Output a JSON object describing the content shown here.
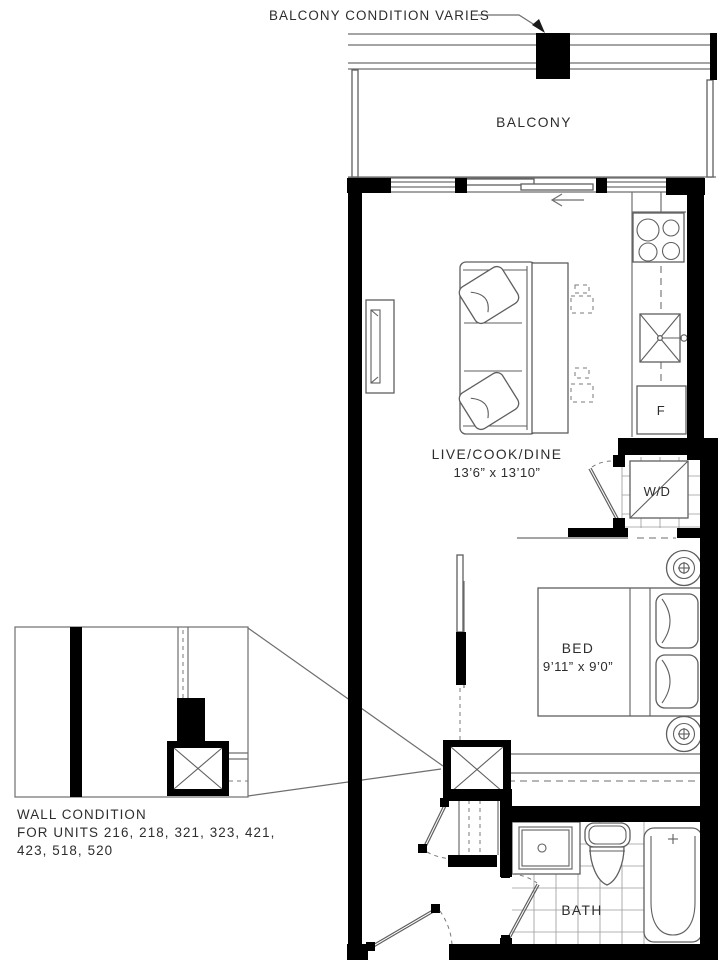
{
  "annotations": {
    "balcony_note": "BALCONY CONDITION VARIES",
    "wall_condition": {
      "line1": "WALL CONDITION",
      "line2": "FOR UNITS 216, 218, 321, 323, 421,",
      "line3": "423, 518, 520"
    }
  },
  "rooms": {
    "balcony": {
      "name": "BALCONY"
    },
    "living": {
      "name": "LIVE/COOK/DINE",
      "dimensions": "13’6” x 13’10”"
    },
    "bedroom": {
      "name": "BED",
      "dimensions": "9’11” x 9’0”"
    },
    "bathroom": {
      "name": "BATH"
    }
  },
  "fixtures": {
    "washer_dryer": "W/D",
    "fridge": "F"
  },
  "colors": {
    "wall": "#000000",
    "line": "#6e6e6e",
    "text": "#2d2d2d",
    "background": "#ffffff"
  }
}
